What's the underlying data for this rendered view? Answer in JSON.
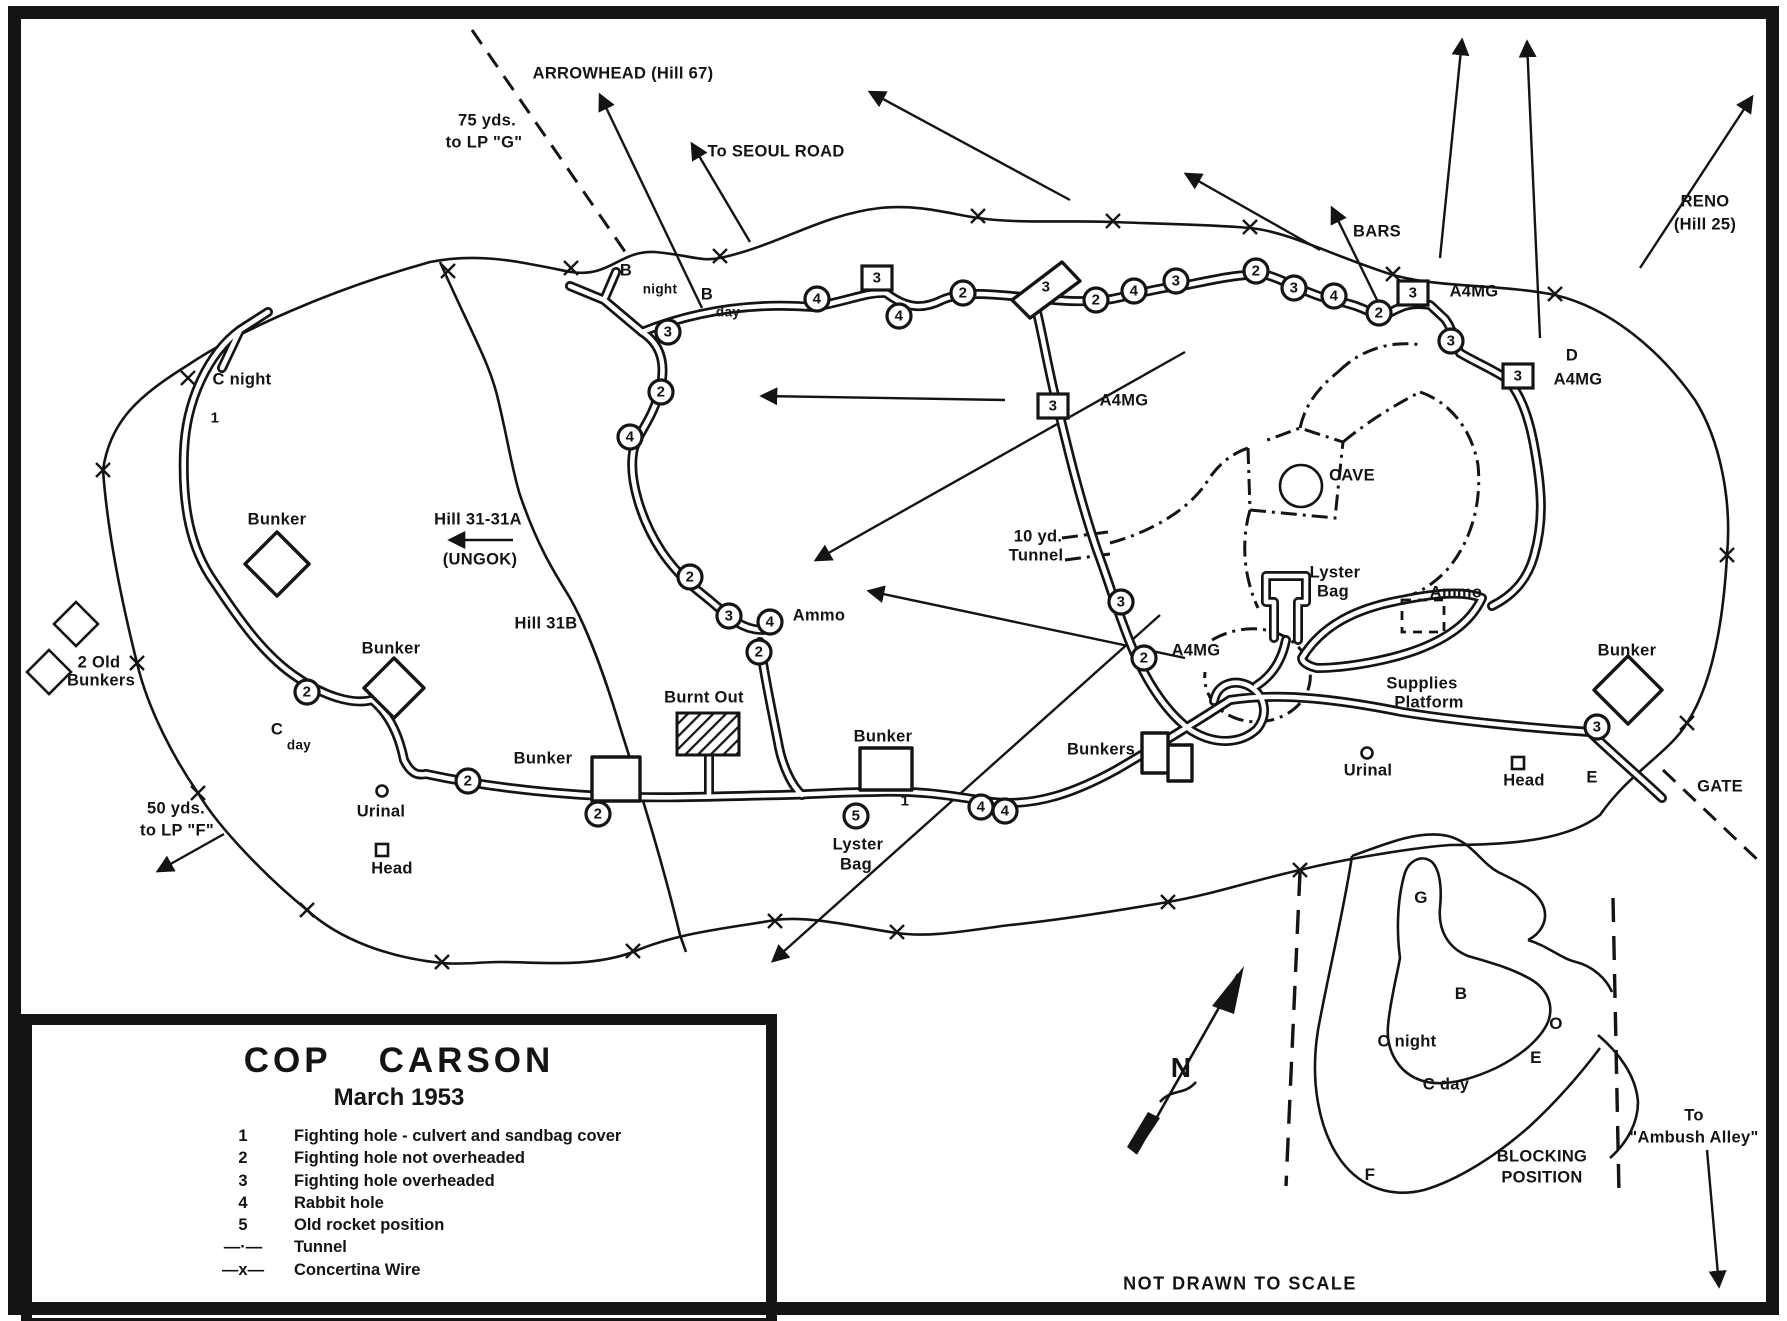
{
  "colors": {
    "ink": "#141414",
    "paper": "#ffffff"
  },
  "legend_box": {
    "title": "COP CARSON",
    "subtitle": "March 1953",
    "items": [
      {
        "key": "1",
        "label": "Fighting hole - culvert and sandbag cover"
      },
      {
        "key": "2",
        "label": "Fighting hole not overheaded"
      },
      {
        "key": "3",
        "label": "Fighting hole overheaded"
      },
      {
        "key": "4",
        "label": "Rabbit hole"
      },
      {
        "key": "5",
        "label": "Old rocket position"
      },
      {
        "key": "—·—",
        "label": "Tunnel"
      },
      {
        "key": "—x—",
        "label": "Concertina Wire"
      }
    ]
  },
  "notes": {
    "scale": "NOT DRAWN TO SCALE"
  },
  "map_labels": [
    {
      "t": "ARROWHEAD (Hill 67)",
      "x": 623,
      "y": 74
    },
    {
      "t": "75 yds.",
      "x": 487,
      "y": 121
    },
    {
      "t": "to LP \"G\"",
      "x": 484,
      "y": 143
    },
    {
      "t": "To SEOUL ROAD",
      "x": 776,
      "y": 152
    },
    {
      "t": "RENO",
      "x": 1705,
      "y": 202
    },
    {
      "t": "(Hill 25)",
      "x": 1705,
      "y": 225
    },
    {
      "t": "BARS",
      "x": 1377,
      "y": 232
    },
    {
      "t": "B",
      "x": 626,
      "y": 271
    },
    {
      "t": "night",
      "x": 660,
      "y": 289,
      "fs": 13.5
    },
    {
      "t": "B",
      "x": 707,
      "y": 295
    },
    {
      "t": "day",
      "x": 728,
      "y": 312,
      "fs": 13.5
    },
    {
      "t": "C night",
      "x": 242,
      "y": 380
    },
    {
      "t": "1",
      "x": 215,
      "y": 418,
      "fs": 15
    },
    {
      "t": "Bunker",
      "x": 277,
      "y": 520
    },
    {
      "t": "Hill 31-31A",
      "x": 478,
      "y": 520
    },
    {
      "t": "(UNGOK)",
      "x": 480,
      "y": 560
    },
    {
      "t": "Hill 31B",
      "x": 546,
      "y": 624
    },
    {
      "t": "2 Old",
      "x": 99,
      "y": 663
    },
    {
      "t": "Bunkers",
      "x": 101,
      "y": 681
    },
    {
      "t": "C",
      "x": 277,
      "y": 730
    },
    {
      "t": "day",
      "x": 299,
      "y": 745,
      "fs": 13.5
    },
    {
      "t": "50 yds.",
      "x": 176,
      "y": 809
    },
    {
      "t": "to LP \"F\"",
      "x": 177,
      "y": 831
    },
    {
      "t": "Urinal",
      "x": 381,
      "y": 812
    },
    {
      "t": "Head",
      "x": 392,
      "y": 869
    },
    {
      "t": "Bunker",
      "x": 391,
      "y": 649
    },
    {
      "t": "Bunker",
      "x": 543,
      "y": 759
    },
    {
      "t": "Burnt Out",
      "x": 704,
      "y": 698
    },
    {
      "t": "Bunker",
      "x": 883,
      "y": 737
    },
    {
      "t": "Lyster",
      "x": 858,
      "y": 845
    },
    {
      "t": "Bag",
      "x": 856,
      "y": 865
    },
    {
      "t": "Ammo",
      "x": 819,
      "y": 616
    },
    {
      "t": "Bunkers",
      "x": 1101,
      "y": 750
    },
    {
      "t": "10 yd.",
      "x": 1038,
      "y": 537
    },
    {
      "t": "Tunnel",
      "x": 1036,
      "y": 556
    },
    {
      "t": "A4MG",
      "x": 1124,
      "y": 401
    },
    {
      "t": "A4MG",
      "x": 1196,
      "y": 651
    },
    {
      "t": "CAVE",
      "x": 1352,
      "y": 476
    },
    {
      "t": "Lyster",
      "x": 1335,
      "y": 573
    },
    {
      "t": "Bag",
      "x": 1333,
      "y": 592
    },
    {
      "t": "Ammo",
      "x": 1456,
      "y": 593
    },
    {
      "t": "Supplies",
      "x": 1422,
      "y": 684
    },
    {
      "t": "Platform",
      "x": 1429,
      "y": 703
    },
    {
      "t": "Urinal",
      "x": 1368,
      "y": 771
    },
    {
      "t": "Head",
      "x": 1524,
      "y": 781
    },
    {
      "t": "Bunker",
      "x": 1627,
      "y": 651
    },
    {
      "t": "E",
      "x": 1592,
      "y": 778
    },
    {
      "t": "GATE",
      "x": 1720,
      "y": 787
    },
    {
      "t": "A4MG",
      "x": 1474,
      "y": 292
    },
    {
      "t": "D",
      "x": 1572,
      "y": 356
    },
    {
      "t": "A4MG",
      "x": 1578,
      "y": 380
    },
    {
      "t": "3",
      "x": 668,
      "y": 332,
      "fs": 15,
      "sym": "c"
    },
    {
      "t": "2",
      "x": 661,
      "y": 392,
      "fs": 15,
      "sym": "c"
    },
    {
      "t": "4",
      "x": 630,
      "y": 437,
      "fs": 15,
      "sym": "c"
    },
    {
      "t": "2",
      "x": 690,
      "y": 577,
      "fs": 15,
      "sym": "c"
    },
    {
      "t": "3",
      "x": 729,
      "y": 616,
      "fs": 15,
      "sym": "c"
    },
    {
      "t": "4",
      "x": 770,
      "y": 622,
      "fs": 15,
      "sym": "c"
    },
    {
      "t": "2",
      "x": 759,
      "y": 652,
      "fs": 15,
      "sym": "c"
    },
    {
      "t": "4",
      "x": 817,
      "y": 299,
      "fs": 15,
      "sym": "c"
    },
    {
      "t": "3",
      "x": 877,
      "y": 278,
      "fs": 15,
      "sym": "s"
    },
    {
      "t": "4",
      "x": 899,
      "y": 316,
      "fs": 15,
      "sym": "c"
    },
    {
      "t": "2",
      "x": 963,
      "y": 293,
      "fs": 15,
      "sym": "c"
    },
    {
      "t": "3",
      "x": 1046,
      "y": 287,
      "fs": 15
    },
    {
      "t": "2",
      "x": 1096,
      "y": 300,
      "fs": 15,
      "sym": "c"
    },
    {
      "t": "4",
      "x": 1134,
      "y": 291,
      "fs": 15,
      "sym": "c"
    },
    {
      "t": "3",
      "x": 1176,
      "y": 281,
      "fs": 15,
      "sym": "c"
    },
    {
      "t": "2",
      "x": 1256,
      "y": 271,
      "fs": 15,
      "sym": "c"
    },
    {
      "t": "3",
      "x": 1294,
      "y": 288,
      "fs": 15,
      "sym": "c"
    },
    {
      "t": "4",
      "x": 1334,
      "y": 296,
      "fs": 15,
      "sym": "c"
    },
    {
      "t": "2",
      "x": 1379,
      "y": 313,
      "fs": 15,
      "sym": "c"
    },
    {
      "t": "3",
      "x": 1413,
      "y": 293,
      "fs": 15,
      "sym": "s"
    },
    {
      "t": "3",
      "x": 1451,
      "y": 341,
      "fs": 15,
      "sym": "c"
    },
    {
      "t": "3",
      "x": 1518,
      "y": 376,
      "fs": 15,
      "sym": "s"
    },
    {
      "t": "3",
      "x": 1053,
      "y": 406,
      "fs": 15,
      "sym": "s"
    },
    {
      "t": "3",
      "x": 1121,
      "y": 602,
      "fs": 15,
      "sym": "c"
    },
    {
      "t": "2",
      "x": 1144,
      "y": 658,
      "fs": 15,
      "sym": "c"
    },
    {
      "t": "2",
      "x": 307,
      "y": 692,
      "fs": 15,
      "sym": "c"
    },
    {
      "t": "2",
      "x": 468,
      "y": 781,
      "fs": 15,
      "sym": "c"
    },
    {
      "t": "2",
      "x": 598,
      "y": 814,
      "fs": 15,
      "sym": "c"
    },
    {
      "t": "5",
      "x": 856,
      "y": 816,
      "fs": 15,
      "sym": "c"
    },
    {
      "t": "1",
      "x": 905,
      "y": 801,
      "fs": 15
    },
    {
      "t": "4",
      "x": 981,
      "y": 807,
      "fs": 15,
      "sym": "c"
    },
    {
      "t": "4",
      "x": 1005,
      "y": 811,
      "fs": 15,
      "sym": "c"
    },
    {
      "t": "3",
      "x": 1597,
      "y": 727,
      "fs": 15,
      "sym": "c"
    },
    {
      "t": "G",
      "x": 1421,
      "y": 898,
      "fs": 17
    },
    {
      "t": "B",
      "x": 1461,
      "y": 994,
      "fs": 17
    },
    {
      "t": "O",
      "x": 1556,
      "y": 1024,
      "fs": 17
    },
    {
      "t": "E",
      "x": 1536,
      "y": 1058,
      "fs": 17
    },
    {
      "t": "C night",
      "x": 1407,
      "y": 1042
    },
    {
      "t": "C day",
      "x": 1446,
      "y": 1085
    },
    {
      "t": "F",
      "x": 1370,
      "y": 1175,
      "fs": 17
    },
    {
      "t": "BLOCKING",
      "x": 1542,
      "y": 1157
    },
    {
      "t": "POSITION",
      "x": 1542,
      "y": 1178
    },
    {
      "t": "To",
      "x": 1694,
      "y": 1116
    },
    {
      "t": "\"Ambush Alley\"",
      "x": 1694,
      "y": 1138
    },
    {
      "t": "N",
      "x": 1181,
      "y": 1068,
      "fs": 28
    }
  ],
  "wire_x": [
    [
      448,
      271
    ],
    [
      571,
      268
    ],
    [
      720,
      256
    ],
    [
      978,
      216
    ],
    [
      1113,
      221
    ],
    [
      1250,
      227
    ],
    [
      1393,
      274
    ],
    [
      1555,
      294
    ],
    [
      1727,
      555
    ],
    [
      1687,
      723
    ],
    [
      1300,
      870
    ],
    [
      1168,
      902
    ],
    [
      897,
      932
    ],
    [
      775,
      921
    ],
    [
      633,
      951
    ],
    [
      442,
      962
    ],
    [
      307,
      910
    ],
    [
      198,
      793
    ],
    [
      137,
      663
    ],
    [
      188,
      378
    ],
    [
      103,
      470
    ]
  ]
}
